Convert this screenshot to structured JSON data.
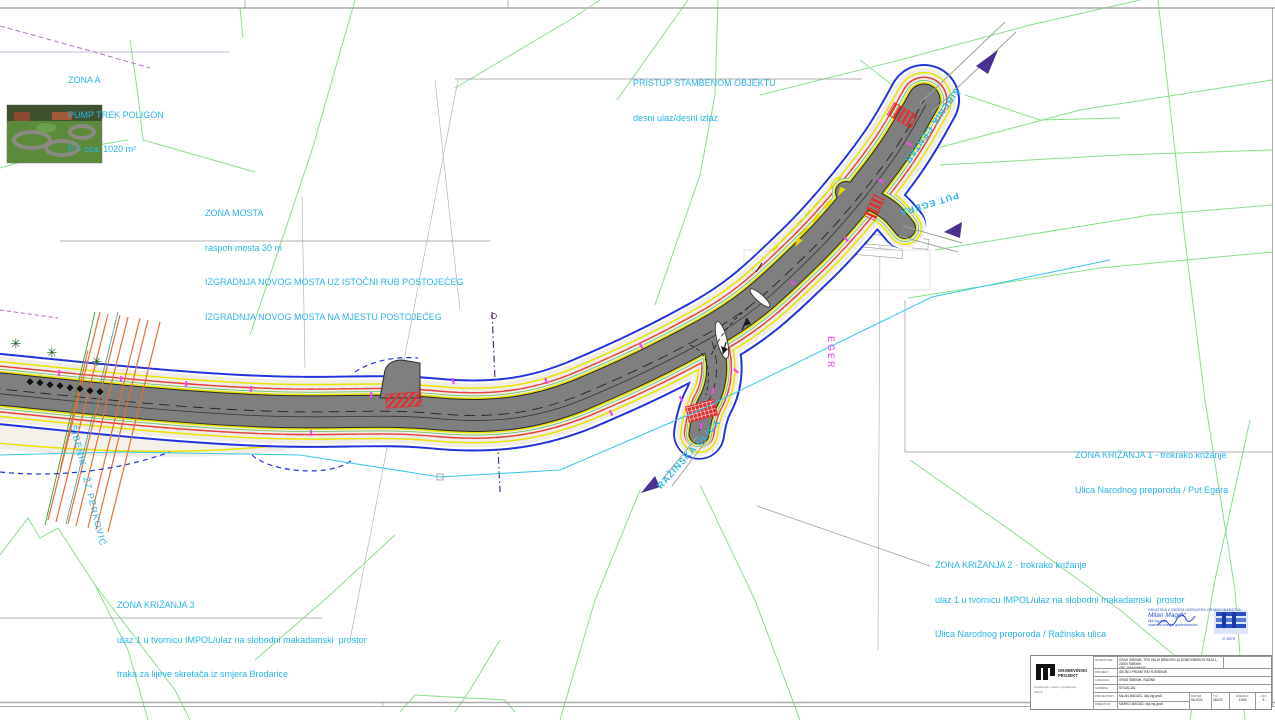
{
  "colors": {
    "annotation_cyan": "#29b4e8",
    "label_magenta": "#e83ce8",
    "boundary_blue": "#2233dd",
    "marking_yellow": "#e8e400",
    "marking_red": "#e84040",
    "parcel_green": "#8ade8a",
    "railway_orange": "#e07038",
    "asphalt_gray": "#7f7f7f",
    "arrow_purple": "#4a3090"
  },
  "annotations": {
    "zona_a": {
      "l1": "ZONA A",
      "l2": "PUMP TREK POLIGON",
      "l3": "P = cca. 1020 m²"
    },
    "pristup": {
      "l1": "PRISTUP STAMBENOM OBJEKTU",
      "l2": "desni ulaz/desni izlaz"
    },
    "zona_mosta": {
      "l1": "ZONA MOSTA",
      "l2": "raspon mosta 30 m",
      "l3": "IZGRADNJA NOVOG MOSTA UZ ISTOČNI RUB POSTOJEĆEG",
      "l4": "IZGRADNJA NOVOG MOSTA NA MJESTU POSTOJEĆEG"
    },
    "zk1": {
      "l1": "ZONA KRIŽANJA 1 - trokrako križanje",
      "l2": "Ulica Narodnog preporoda / Put Egera"
    },
    "zk2": {
      "l1": "ZONA KRIŽANJA 2 - trokrako križanje",
      "l2": "ulaz 1 u tvornicu IMPOL/ulaz na slobodni makadamski  prostor",
      "l3": "Ulica Narodnog preporoda / Ražinska ulica"
    },
    "zk3": {
      "l1": "ZONA KRIŽANJA 3",
      "l2": "ulaz 1 u tvornicu IMPOL/ulaz na slobodni makadamski  prostor",
      "l3": "traka za lijeve skretača iz smjera Brodarice"
    }
  },
  "road_labels": {
    "sibenik_centar": "ŠIBENIK CENTAR",
    "put_egera": "PUT EGERA",
    "razinska": "RAŽINSKA ULICA",
    "eger": "EGER",
    "railway": "ŠIBENIK - ŽZ PERKOVIĆ"
  },
  "stamp": {
    "org": "HRVATSKA KOMORA INŽENJERA GRAĐEVINARSTVA",
    "name": "Milan Magdić",
    "title": "dipl.ing.građ.",
    "role": "ovlašteni inženjer građevinarstva",
    "number": "G 5679"
  },
  "title_block": {
    "company": "GRAĐEVINSKI PROJEKT",
    "company_sub1": "projektiranje i nadzor u graditeljstvu",
    "company_sub2": "Šibenik",
    "rows": [
      {
        "label": "INVESTITOR:",
        "value": "GRAD ŠIBENIK, TRG PALIH BRANITELJA DOMOVINSKOG RATA 1, 22000 ŠIBENIK",
        "value2": "OIB: 15644094630"
      },
      {
        "label": "PROJEKT:",
        "value": "IDEJNO PROMETNO RJEŠENJE"
      },
      {
        "label": "LOKACIJA:",
        "value": "GRAD ŠIBENIK, RAŽINE"
      },
      {
        "label": "SADRŽAJ:",
        "value": "SITUACIJA"
      },
      {
        "label": "PROJEKTANT:",
        "value": "MILAN MAGDIĆ, dipl.ing.građ."
      },
      {
        "label": "DIREKTOR:",
        "value": "MARKO MAGUD, dipl.ing.građ."
      }
    ],
    "meta": [
      {
        "label": "DATUM:",
        "value": "06.2022"
      },
      {
        "label": "T.D.:",
        "value": "261/21"
      },
      {
        "label": "MJERILO:",
        "value": "1:500"
      },
      {
        "label": "LIST:",
        "value": "5"
      }
    ]
  }
}
